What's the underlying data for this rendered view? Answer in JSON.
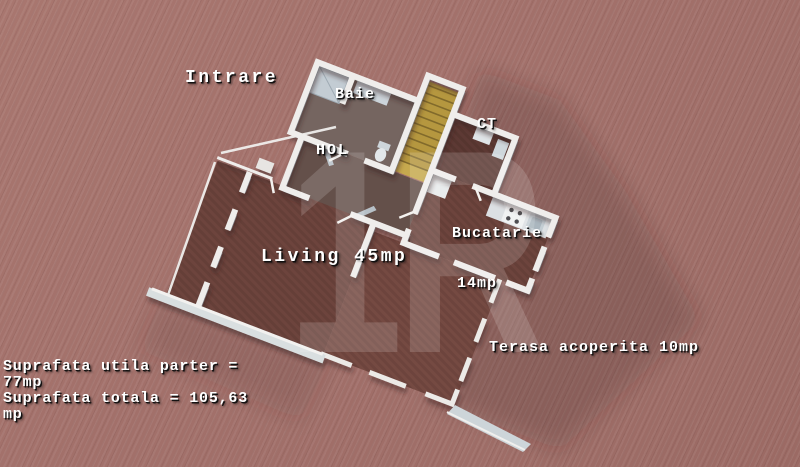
{
  "scene": {
    "description": "3D rendered ground-floor plan of a house viewed from above, rotated, on a terracotta woven background",
    "watermark": {
      "text": "1R"
    }
  },
  "rooms": {
    "intrare": "Intrare",
    "baie": "Baie",
    "hol": "HOL",
    "ct": "CT",
    "bucatarie": "Bucatarie",
    "bucatarie_area": "14mp",
    "living": "Living 45mp",
    "terasa": "Terasa acoperita 10mp"
  },
  "area_summary": {
    "line1": "Suprafata utila parter =",
    "line2": "77mp",
    "line3": "Suprafata totala = 105,63",
    "line4": "mp"
  },
  "colors": {
    "background": "#a2706a",
    "room_floor": "#6d443d",
    "walls": "#efedeb",
    "stairs": "#b5973f",
    "label_text": "#ffffff",
    "watermark": "#ffffff"
  }
}
